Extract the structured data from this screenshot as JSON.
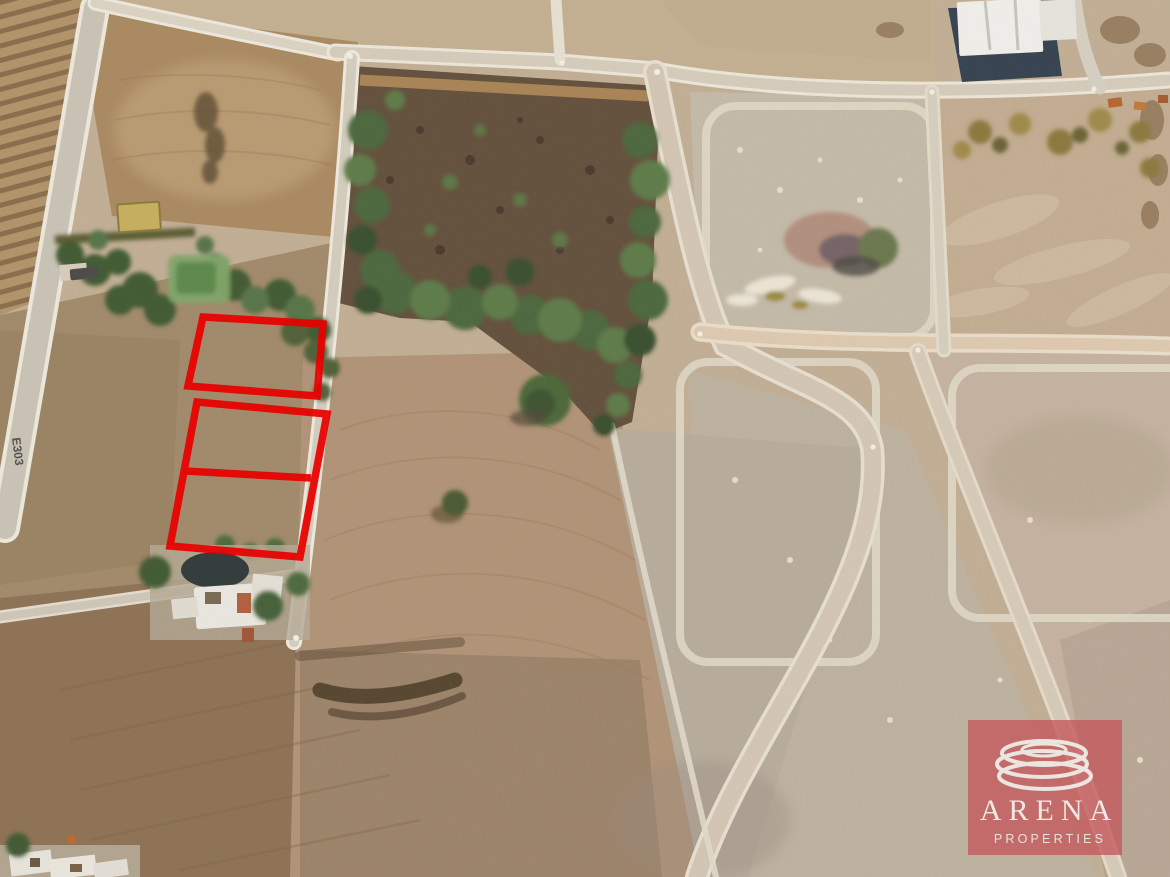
{
  "watermark": {
    "brand": "ARENA",
    "tagline": "PROPERTIES",
    "box_color": "#c4575c",
    "box_opacity": "0.78",
    "text_color": "#eceae3",
    "icon": "concentric-rings-icon"
  },
  "map": {
    "road_label": "E303",
    "outline_color": "#e80000",
    "plots": [
      {
        "name": "plot-outline-1",
        "attrs": {
          "points": "203,317 323,324 317,396 188,386"
        }
      },
      {
        "name": "plot-outline-2-3",
        "attrs": {
          "points": "197,402 327,414 300,557 170,546"
        }
      },
      {
        "name": "plot-divider-line",
        "attrs": {
          "x1": "185",
          "y1": "471",
          "x2": "311",
          "y2": "478"
        }
      }
    ]
  }
}
